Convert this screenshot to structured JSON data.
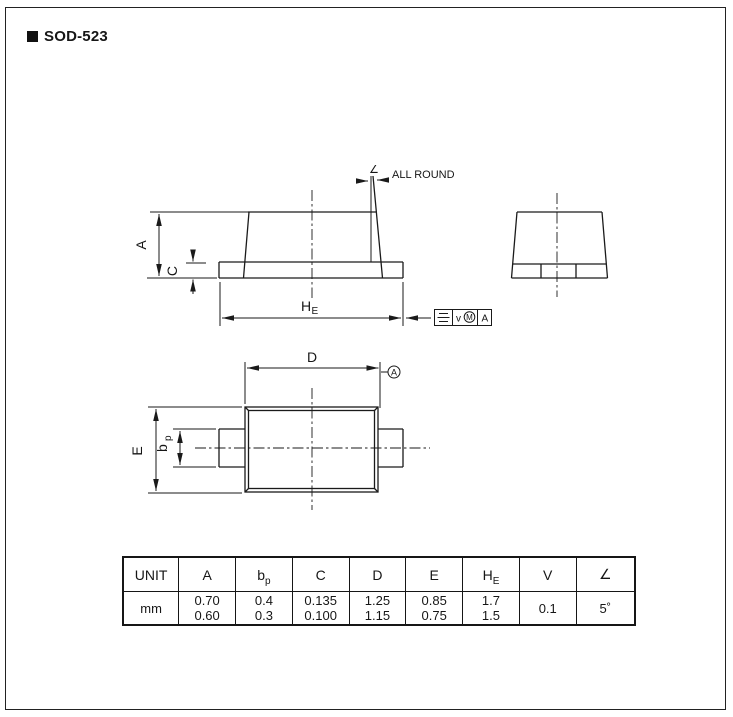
{
  "page": {
    "title": "SOD-523"
  },
  "drawing": {
    "labels": {
      "dim_a": "A",
      "dim_c": "C",
      "dim_he_main": "H",
      "dim_he_sub": "E",
      "angle_symbol": "∠",
      "all_round": "ALL ROUND",
      "dim_d": "D",
      "dim_e": "E",
      "dim_bp_main": "b",
      "dim_bp_sub": "p",
      "datum_label": "A",
      "fcf_tolerance": "v",
      "fcf_modifier": "M",
      "fcf_datum_ref": "A"
    },
    "colors": {
      "line": "#1a1a1a",
      "background": "#ffffff"
    }
  },
  "table": {
    "unit_header": "UNIT",
    "unit_value": "mm",
    "columns": [
      {
        "main": "A",
        "sub": "",
        "max": "0.70",
        "min": "0.60"
      },
      {
        "main": "b",
        "sub": "p",
        "max": "0.4",
        "min": "0.3"
      },
      {
        "main": "C",
        "sub": "",
        "max": "0.135",
        "min": "0.100"
      },
      {
        "main": "D",
        "sub": "",
        "max": "1.25",
        "min": "1.15"
      },
      {
        "main": "E",
        "sub": "",
        "max": "0.85",
        "min": "0.75"
      },
      {
        "main": "H",
        "sub": "E",
        "max": "1.7",
        "min": "1.5"
      },
      {
        "main": "V",
        "sub": "",
        "single": "0.1"
      },
      {
        "main": "∠",
        "sub": "",
        "single": "5˚"
      }
    ]
  }
}
